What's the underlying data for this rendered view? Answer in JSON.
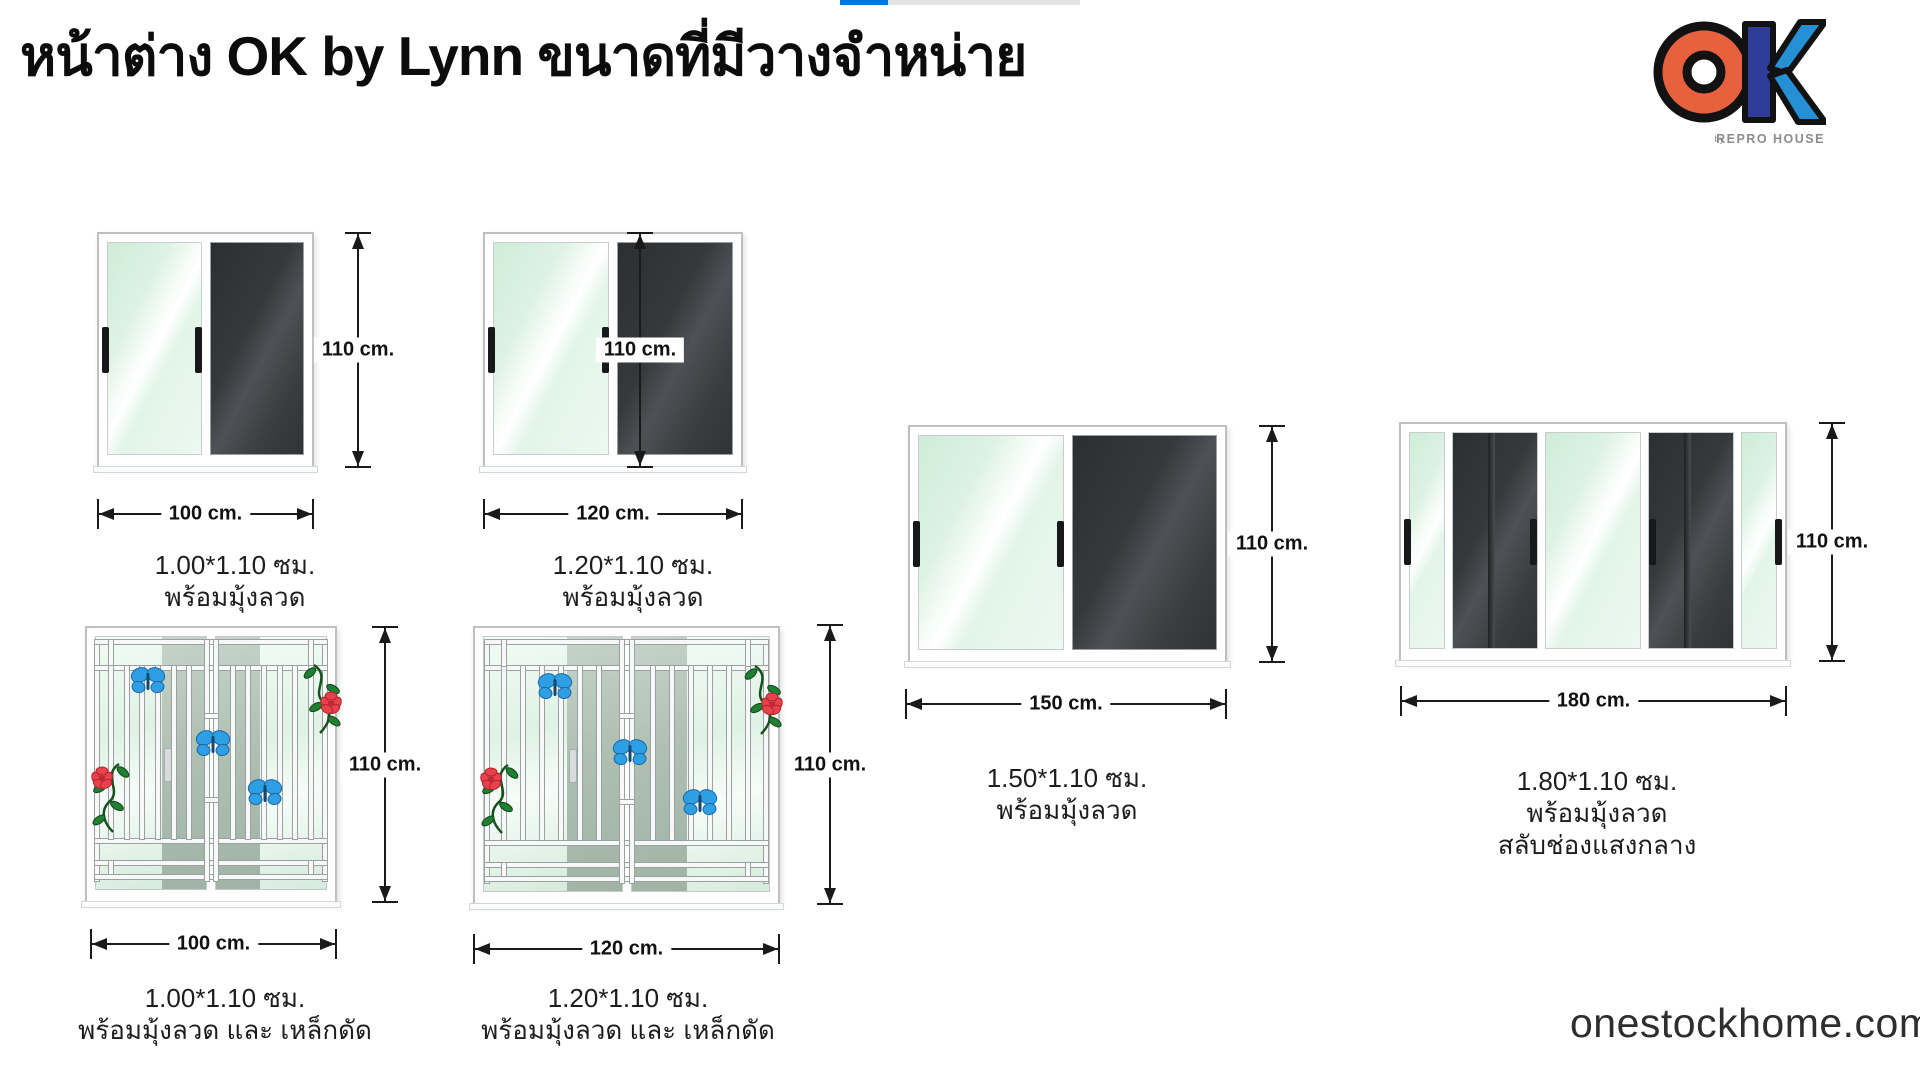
{
  "header": {
    "title": "หน้าต่าง OK by Lynn ขนาดที่มีวางจำหน่าย"
  },
  "carousel": {
    "progress_percent": 20
  },
  "logo": {
    "text": "OK",
    "byline_by": "by",
    "byline_name": "REPRO HOUSE",
    "colors": {
      "o_fill": "#E8613F",
      "k_bar_fill": "#2F3D99",
      "k_diag_fill": "#2590D4",
      "outline": "#121212",
      "byline": "#8C8C8C"
    }
  },
  "footer": {
    "website": "onestockhome.com"
  },
  "colors": {
    "accent_blue": "#0078d4",
    "track_gray": "#e4e4e4",
    "glass_green": "#ddf2e3",
    "screen_dark": "#36393c",
    "frame_white": "#ffffff",
    "butterfly_blue": "#2f9fe3",
    "flower_red": "#e8414b",
    "leaf_green": "#1e8030"
  },
  "windows": [
    {
      "id": "100-screen",
      "width_label": "100 cm.",
      "height_label": "110 cm.",
      "caption_lines": [
        "1.00*1.10 ซม.",
        "พร้อมมุ้งลวด"
      ]
    },
    {
      "id": "120-screen",
      "width_label": "120 cm.",
      "height_label": "110 cm.",
      "caption_lines": [
        "1.20*1.10 ซม.",
        "พร้อมมุ้งลวด"
      ]
    },
    {
      "id": "150-screen",
      "width_label": "150 cm.",
      "height_label": "110 cm.",
      "caption_lines": [
        "1.50*1.10 ซม.",
        "พร้อมมุ้งลวด"
      ]
    },
    {
      "id": "180-screen-centerlight",
      "width_label": "180 cm.",
      "height_label": "110 cm.",
      "caption_lines": [
        "1.80*1.10 ซม.",
        "พร้อมมุ้งลวด",
        "สลับช่องแสงกลาง"
      ]
    },
    {
      "id": "100-screen-grille",
      "width_label": "100 cm.",
      "height_label": "110 cm.",
      "caption_lines": [
        "1.00*1.10 ซม.",
        "พร้อมมุ้งลวด และ เหล็กดัด"
      ]
    },
    {
      "id": "120-screen-grille",
      "width_label": "120 cm.",
      "height_label": "110 cm.",
      "caption_lines": [
        "1.20*1.10 ซม.",
        "พร้อมมุ้งลวด และ เหล็กดัด"
      ]
    }
  ]
}
